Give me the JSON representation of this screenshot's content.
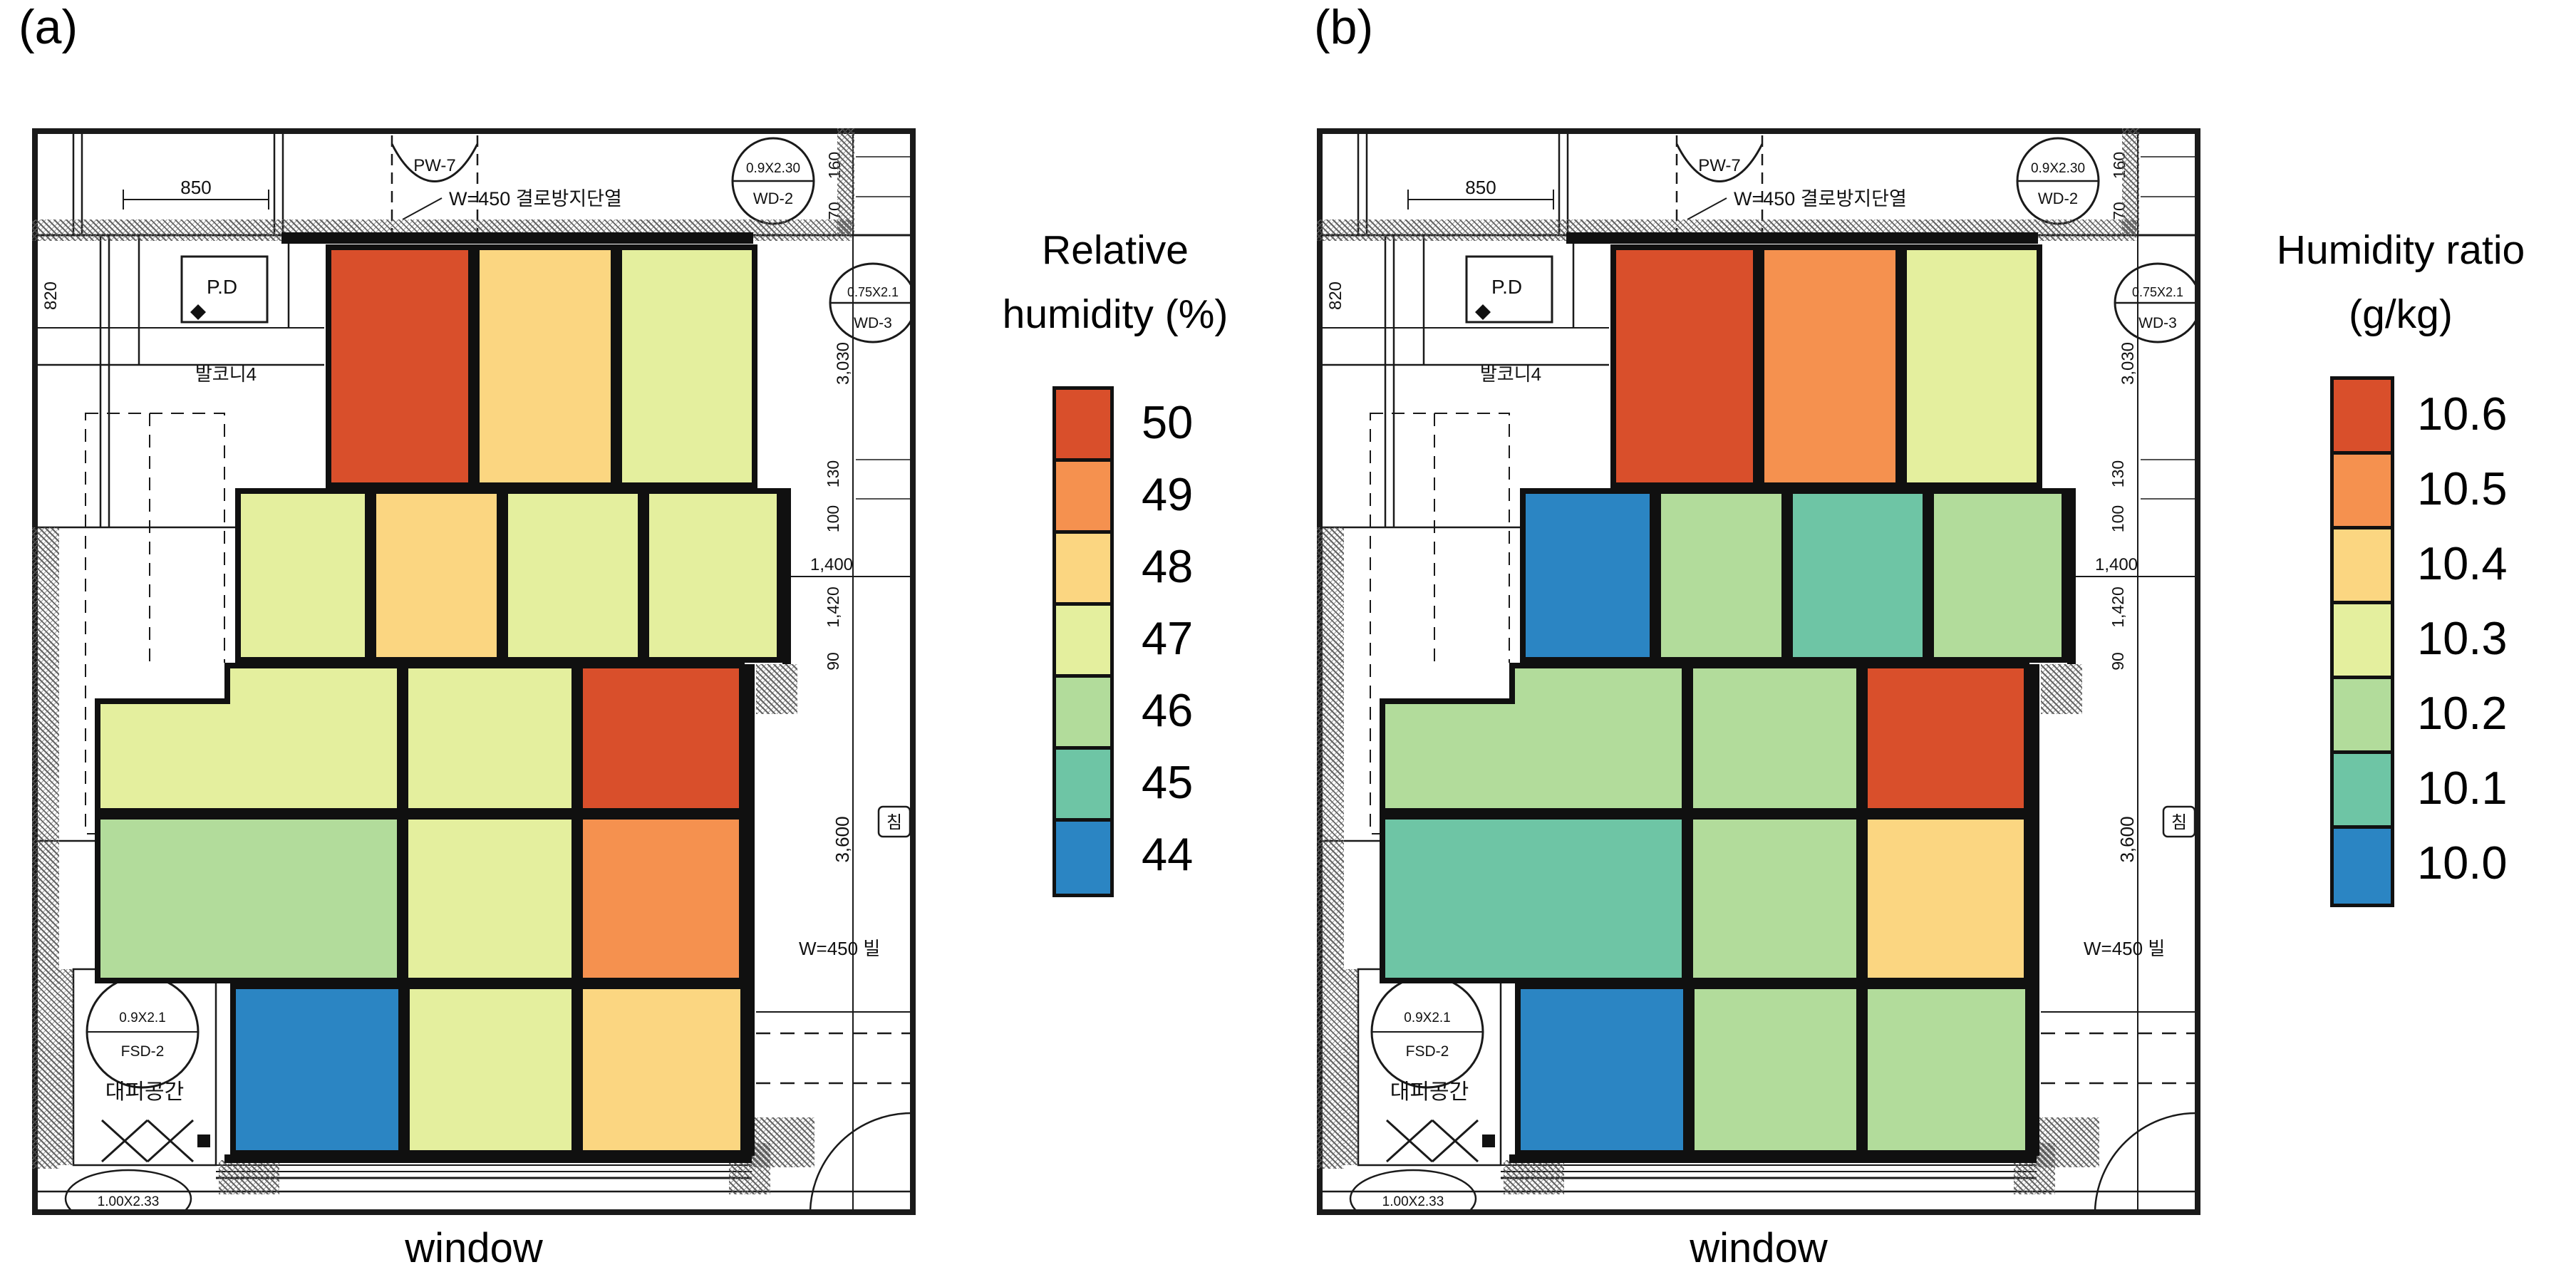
{
  "figure": {
    "panel_a_label": "(a)",
    "panel_b_label": "(b)",
    "window_label": "window"
  },
  "legend_a": {
    "line1": "Relative",
    "line2": "humidity (%)"
  },
  "legend_b": {
    "line1": "Humidity ratio",
    "line2": "(g/kg)"
  },
  "plan": {
    "dim_850": "850",
    "pw7": "PW-7",
    "insulation": "W=450 결로방지단열",
    "wd2_size": "0.9X2.30",
    "wd2": "WD-2",
    "dim_820": "820",
    "pd": "P.D",
    "balcony": "발코니4",
    "wd3_size": "0.75X2.1",
    "wd3": "WD-3",
    "dim_160": "160",
    "dim_70": "70",
    "dim_3030": "3,030",
    "dim_130": "130",
    "dim_100": "100",
    "dim_1400": "1,400",
    "dim_1420": "1,420",
    "dim_90": "90",
    "dim_3600": "3,600",
    "w450_side": "W=450 빌",
    "room": "침",
    "fsd_size": "0.9X2.1",
    "fsd": "FSD-2",
    "evac": "대피공간",
    "door": "1.00X2.33"
  },
  "chart_data": [
    {
      "type": "heatmap",
      "panel": "a",
      "title": "Relative humidity (%)",
      "units": "%",
      "colorbar": {
        "labels": [
          "50",
          "49",
          "48",
          "47",
          "46",
          "45",
          "44"
        ],
        "values": [
          50,
          49,
          48,
          47,
          46,
          45,
          44
        ],
        "colors": [
          "#d94f2b",
          "#f5914f",
          "#fbd681",
          "#e4ef9e",
          "#b2dc9b",
          "#6ec5a5",
          "#2b85c3"
        ],
        "position": "right"
      },
      "rows": [
        [
          50,
          48,
          47
        ],
        [
          47,
          48,
          47,
          47
        ],
        [
          47,
          47,
          50
        ],
        [
          46,
          47,
          49
        ],
        [
          44,
          47,
          48
        ]
      ]
    },
    {
      "type": "heatmap",
      "panel": "b",
      "title": "Humidity ratio (g/kg)",
      "units": "g/kg",
      "colorbar": {
        "labels": [
          "10.6",
          "10.5",
          "10.4",
          "10.3",
          "10.2",
          "10.1",
          "10.0"
        ],
        "values": [
          10.6,
          10.5,
          10.4,
          10.3,
          10.2,
          10.1,
          10.0
        ],
        "colors": [
          "#d94f2b",
          "#f5914f",
          "#fbd681",
          "#e4ef9e",
          "#b2dc9b",
          "#6ec5a5",
          "#2b85c3"
        ],
        "position": "right"
      },
      "rows": [
        [
          10.6,
          10.5,
          10.3
        ],
        [
          10.0,
          10.2,
          10.1,
          10.2
        ],
        [
          10.2,
          10.2,
          10.6
        ],
        [
          10.1,
          10.2,
          10.4
        ],
        [
          10.0,
          10.2,
          10.2
        ]
      ]
    }
  ]
}
